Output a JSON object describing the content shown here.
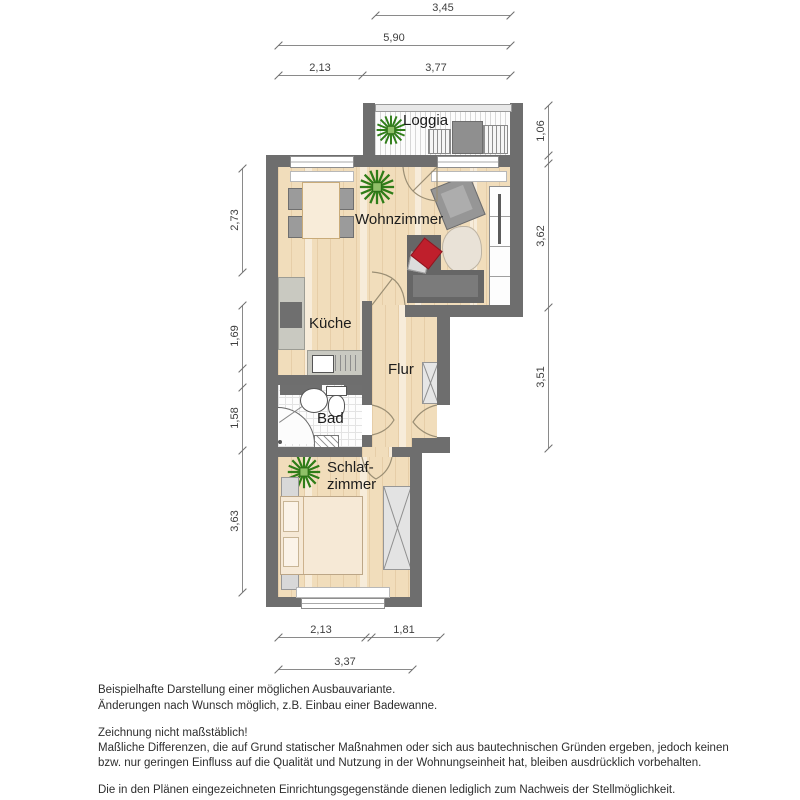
{
  "rooms": {
    "loggia": "Loggia",
    "wohnzimmer": "Wohnzimmer",
    "kueche": "Küche",
    "flur": "Flur",
    "bad": "Bad",
    "schlafzimmer_line1": "Schlaf-",
    "schlafzimmer_line2": "zimmer"
  },
  "dimensions_m": {
    "top_loggia": "3,45",
    "top_total": "5,90",
    "top_left": "2,13",
    "top_right": "3,77",
    "right_loggia": "1,06",
    "right_wohnzimmer": "3,62",
    "right_flur": "3,51",
    "left_wohnzimmer": "2,73",
    "left_kueche": "1,69",
    "left_bad": "1,58",
    "left_schlafzimmer": "3,63",
    "bottom_schlafzimmer": "2,13",
    "bottom_flur": "1,81",
    "bottom_total": "3,37"
  },
  "footer": {
    "line1": "Beispielhafte Darstellung einer möglichen Ausbauvariante.",
    "line2": "Änderungen nach Wunsch möglich, z.B. Einbau einer Badewanne.",
    "line3": "Zeichnung nicht maßstäblich!",
    "line4": "Maßliche Differenzen, die auf Grund statischer Maßnahmen oder sich aus bautechnischen Gründen ergeben, jedoch keinen",
    "line5": "bzw. nur geringen Einfluss auf die Qualität und Nutzung in der Wohnungseinheit hat, bleiben ausdrücklich vorbehalten.",
    "line6": "Die in den Plänen eingezeichneten Einrichtungsgegenstände dienen lediglich zum Nachweis der Stellmöglichkeit."
  },
  "colors": {
    "wall": "#6e6e6e",
    "wood_floor": "#f1ddbb",
    "counter": "#c9c9c1",
    "sofa": "#666666",
    "pillow_red": "#bf1f2c",
    "plant_green": "#2f7d18",
    "dimension_text": "#3f3f3f"
  }
}
